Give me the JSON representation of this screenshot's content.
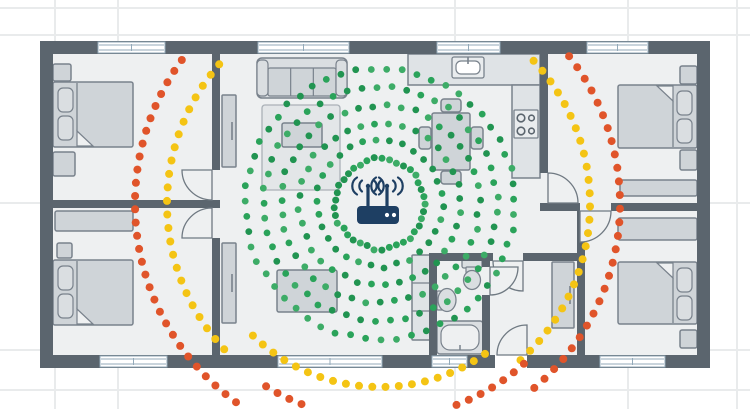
{
  "canvas": {
    "width": 750,
    "height": 409
  },
  "colors": {
    "bg": "#ffffff",
    "grid": "#e9ebec",
    "wall": "#5b656e",
    "floor": "#eef0f1",
    "line": "#79828c",
    "door_line": "#6f7982",
    "furn": "#cfd4d8",
    "furn_light": "#dadee1",
    "furn_pale": "#e9ecee",
    "counter": "#dfe3e6",
    "rug": "#e3e6e8",
    "rug_line": "#aab1b7",
    "window_frame": "#93aaba",
    "white": "#ffffff",
    "router_navy": "#1e3f63",
    "green_dot": "#2aa35a",
    "green_dot_dark": "#219451",
    "green_dot_light": "#3dac67",
    "yellow_dot": "#f4c414",
    "orange_dot": "#e0542a"
  },
  "background_grid": {
    "x_lines": [
      55,
      118,
      455,
      628,
      737
    ],
    "y_lines": [
      8,
      35,
      203,
      350,
      390
    ]
  },
  "house": {
    "floor": [
      53,
      54,
      644,
      301
    ]
  },
  "walls": [
    [
      40,
      41,
      670,
      13
    ],
    [
      40,
      355,
      455,
      13
    ],
    [
      527,
      355,
      183,
      13
    ],
    [
      40,
      41,
      13,
      327
    ],
    [
      697,
      41,
      13,
      327
    ],
    [
      212,
      54,
      8,
      116
    ],
    [
      212,
      200,
      8,
      8
    ],
    [
      212,
      238,
      8,
      117
    ],
    [
      53,
      200,
      159,
      8
    ],
    [
      540,
      54,
      8,
      119
    ],
    [
      540,
      203,
      40,
      8
    ],
    [
      611,
      203,
      86,
      8
    ],
    [
      577,
      211,
      8,
      144
    ],
    [
      429,
      253,
      8,
      102
    ],
    [
      429,
      253,
      64,
      8
    ],
    [
      523,
      253,
      54,
      8
    ],
    [
      482,
      261,
      8,
      6
    ],
    [
      482,
      295,
      8,
      60
    ]
  ],
  "windows": [
    {
      "x": 98,
      "y": 42,
      "w": 67,
      "h": 11
    },
    {
      "x": 258,
      "y": 42,
      "w": 91,
      "h": 11
    },
    {
      "x": 437,
      "y": 42,
      "w": 63,
      "h": 11
    },
    {
      "x": 587,
      "y": 42,
      "w": 61,
      "h": 11
    },
    {
      "x": 100,
      "y": 356,
      "w": 67,
      "h": 11
    },
    {
      "x": 278,
      "y": 356,
      "w": 104,
      "h": 11
    },
    {
      "x": 432,
      "y": 356,
      "w": 35,
      "h": 11
    },
    {
      "x": 600,
      "y": 356,
      "w": 65,
      "h": 11
    }
  ],
  "entrance_sill": [
    495,
    355,
    32,
    13
  ],
  "doors": [
    {
      "c": [
        212,
        170
      ],
      "s": [
        -1,
        1
      ],
      "r": 30
    },
    {
      "c": [
        212,
        238
      ],
      "s": [
        -1,
        -1
      ],
      "r": 30
    },
    {
      "c": [
        548,
        203
      ],
      "s": [
        1,
        -1
      ],
      "r": 30
    },
    {
      "c": [
        580,
        211
      ],
      "s": [
        1,
        1
      ],
      "r": 31
    },
    {
      "c": [
        523,
        261
      ],
      "s": [
        -1,
        1
      ],
      "r": 30
    },
    {
      "c": [
        490,
        267
      ],
      "s": [
        1,
        1
      ],
      "r": 28
    },
    {
      "c": [
        527,
        355
      ],
      "s": [
        -1,
        -1
      ],
      "r": 30
    }
  ],
  "furniture": [
    {
      "t": "rect",
      "x": 53,
      "y": 64,
      "w": 18,
      "h": 17
    },
    {
      "t": "bed",
      "x": 53,
      "y": 82,
      "w": 80,
      "h": 65,
      "side": "left"
    },
    {
      "t": "rect",
      "x": 53,
      "y": 152,
      "w": 22,
      "h": 24
    },
    {
      "t": "wardrobe",
      "x": 222,
      "y": 95,
      "w": 14,
      "h": 72
    },
    {
      "t": "rect",
      "x": 55,
      "y": 211,
      "w": 78,
      "h": 20
    },
    {
      "t": "rect",
      "x": 57,
      "y": 243,
      "w": 15,
      "h": 15
    },
    {
      "t": "bed",
      "x": 53,
      "y": 260,
      "w": 80,
      "h": 65,
      "side": "left"
    },
    {
      "t": "wardrobe",
      "x": 222,
      "y": 243,
      "w": 14,
      "h": 80
    },
    {
      "t": "sofa",
      "x": 257,
      "y": 58,
      "w": 90,
      "h": 40
    },
    {
      "t": "rug",
      "x": 262,
      "y": 105,
      "w": 78,
      "h": 85
    },
    {
      "t": "rect",
      "x": 282,
      "y": 123,
      "w": 40,
      "h": 24
    },
    {
      "t": "rect",
      "x": 277,
      "y": 270,
      "w": 60,
      "h": 42
    },
    {
      "t": "shelf",
      "x": 412,
      "y": 255,
      "w": 18,
      "h": 85
    },
    {
      "t": "rect",
      "x": 441,
      "y": 99,
      "w": 20,
      "h": 13,
      "rx": 3
    },
    {
      "t": "rect",
      "x": 441,
      "y": 171,
      "w": 20,
      "h": 13,
      "rx": 3
    },
    {
      "t": "rect",
      "x": 419,
      "y": 127,
      "w": 12,
      "h": 22,
      "rx": 3
    },
    {
      "t": "rect",
      "x": 471,
      "y": 127,
      "w": 12,
      "h": 22,
      "rx": 3
    },
    {
      "t": "rect",
      "x": 432,
      "y": 113,
      "w": 38,
      "h": 57
    },
    {
      "t": "counter",
      "x": 408,
      "y": 54,
      "w": 132,
      "h": 31
    },
    {
      "t": "counter",
      "x": 512,
      "y": 85,
      "w": 28,
      "h": 93
    },
    {
      "t": "sink",
      "x": 452,
      "y": 57,
      "w": 32,
      "h": 21
    },
    {
      "t": "stove",
      "x": 514,
      "y": 110,
      "w": 24,
      "h": 28
    },
    {
      "t": "rect",
      "x": 680,
      "y": 66,
      "w": 17,
      "h": 18
    },
    {
      "t": "bed",
      "x": 618,
      "y": 85,
      "w": 79,
      "h": 63,
      "side": "right"
    },
    {
      "t": "rect",
      "x": 680,
      "y": 150,
      "w": 17,
      "h": 20
    },
    {
      "t": "rect",
      "x": 620,
      "y": 180,
      "w": 77,
      "h": 16
    },
    {
      "t": "rect",
      "x": 618,
      "y": 218,
      "w": 79,
      "h": 22
    },
    {
      "t": "bed",
      "x": 618,
      "y": 262,
      "w": 79,
      "h": 62,
      "side": "right"
    },
    {
      "t": "rect",
      "x": 680,
      "y": 330,
      "w": 17,
      "h": 18
    },
    {
      "t": "wardrobe",
      "x": 552,
      "y": 262,
      "w": 22,
      "h": 66
    },
    {
      "t": "toilet",
      "x": 462,
      "y": 257
    },
    {
      "t": "bathsink",
      "x": 437,
      "y": 289
    },
    {
      "t": "tub",
      "x": 437,
      "y": 321,
      "w": 46,
      "h": 33
    }
  ],
  "router": {
    "body": [
      357,
      206,
      42,
      18
    ],
    "antenna_x": [
      368,
      387
    ],
    "antenna_top_y": 187,
    "wave_center_y": 186,
    "led_dots": [
      [
        387,
        215
      ],
      [
        394,
        215
      ]
    ]
  },
  "signal": {
    "center": [
      380,
      204
    ],
    "green_rings": [
      {
        "r": 45,
        "step": 7.6,
        "size": 3.5
      },
      {
        "r": 63,
        "step": 13,
        "size": 3.4
      },
      {
        "r": 81,
        "step": 14,
        "size": 3.4
      },
      {
        "r": 99,
        "step": 14.5,
        "size": 3.4
      },
      {
        "r": 117,
        "step": 15,
        "size": 3.4
      },
      {
        "r": 135,
        "step": 15.5,
        "size": 3.4
      }
    ],
    "jitter": 1.8,
    "arcs": [
      {
        "color": "yellow",
        "r": 213,
        "a0": 137,
        "a1": 221,
        "size": 4
      },
      {
        "color": "yellow",
        "r": 210,
        "a0": -43,
        "a1": 48,
        "size": 4
      },
      {
        "color": "yellow",
        "r": 183,
        "a0": 55,
        "a1": 134,
        "size": 4
      },
      {
        "color": "orange",
        "r": 245,
        "a0": 126,
        "a1": 216,
        "size": 4
      },
      {
        "color": "orange",
        "r": 240,
        "a0": -38,
        "a1": 50,
        "size": 4
      },
      {
        "color": "orange",
        "r": 215,
        "a0": 48,
        "a1": 122,
        "size": 4
      }
    ],
    "arc_step": 13.5,
    "top_clip_y": 56
  }
}
